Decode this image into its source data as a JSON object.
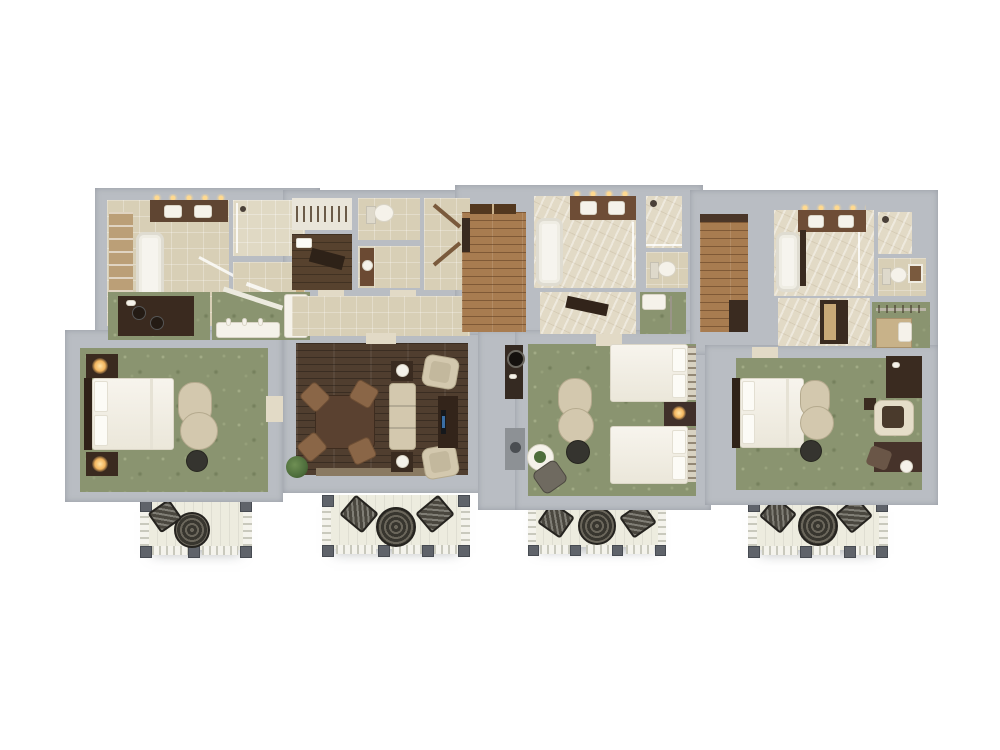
{
  "figure": {
    "type": "floorplan-3d-render",
    "description": "Top-down 3D rendering of a multi-bedroom hotel suite: three bedrooms, living-dining room, three bathrooms, closets, entry corridors and four furnished terraces",
    "background": "#ffffff",
    "visible_text": ""
  },
  "palette": {
    "wall": "#b9bdc3",
    "carpet_green": "#8a9470",
    "tile_beige": "#d8cfb6",
    "marble_cream": "#e2dac6",
    "wood_dark": "#503e2f",
    "wood_medium": "#a87c50",
    "balcony_floor": "#edecdf",
    "post_gray": "#5f636a",
    "upholstery_beige": "#d3c8ae",
    "furniture_brown": "#3a2b20",
    "bedding_white": "#f5f2ea",
    "lamp_glow": "#f3b65f",
    "plant_green": "#4e6e3c"
  },
  "rooms": [
    {
      "name": "Bathroom (left suite)",
      "floor": "tile",
      "items": [
        "double vanity with mirror lights",
        "bathtub",
        "towel shelves"
      ]
    },
    {
      "name": "Shower (left suite)",
      "floor": "tile",
      "items": [
        "glass shower"
      ]
    },
    {
      "name": "Wet room (left suite)",
      "floor": "tile",
      "items": [
        "towel bar",
        "bench"
      ]
    },
    {
      "name": "Dressing room (left suite)",
      "floor": "carpet",
      "items": [
        "vanity dresser"
      ]
    },
    {
      "name": "Walk-in closet (left suite)",
      "floor": "carpet",
      "items": [
        "counter",
        "bench",
        "ironing board"
      ]
    },
    {
      "name": "King bedroom (left suite)",
      "floor": "carpet",
      "items": [
        "king bed",
        "two nightstands with lamps",
        "chaise lounge",
        "round ottoman"
      ]
    },
    {
      "name": "Living and dining room",
      "floor": "dark wood",
      "items": [
        "dining table with four chairs",
        "sofa",
        "two armchairs",
        "two side tables with lamps",
        "TV console",
        "potted plant"
      ]
    },
    {
      "name": "Wardrobe room",
      "floor": "wood",
      "items": [
        "hanging clothes",
        "bench"
      ]
    },
    {
      "name": "Guest toilet",
      "floor": "tile",
      "items": [
        "toilet"
      ]
    },
    {
      "name": "Powder room",
      "floor": "tile",
      "items": [
        "sink vanity"
      ]
    },
    {
      "name": "Hallway",
      "floor": "tile",
      "items": [
        "doors"
      ]
    },
    {
      "name": "Entry hall",
      "floor": "tile",
      "items": []
    },
    {
      "name": "Entry corridor (middle suite)",
      "floor": "wood",
      "items": [
        "double entry door",
        "console"
      ]
    },
    {
      "name": "Bathroom (middle suite)",
      "floor": "marble",
      "items": [
        "double vanity with mirror lights",
        "bathtub",
        "glass partition"
      ]
    },
    {
      "name": "Shower (middle suite)",
      "floor": "marble",
      "items": [
        "glass shower"
      ]
    },
    {
      "name": "Water closet (middle suite)",
      "floor": "tile",
      "items": [
        "toilet"
      ]
    },
    {
      "name": "Dressing area (middle suite)",
      "floor": "marble",
      "items": [
        "bench"
      ]
    },
    {
      "name": "Closet (middle suite)",
      "floor": "carpet",
      "items": [
        "cabinet",
        "hanging rail"
      ]
    },
    {
      "name": "Twin bedroom (middle suite)",
      "floor": "carpet",
      "items": [
        "two beds with upholstered headboards",
        "nightstand with lamp",
        "chaise lounge",
        "round ottoman",
        "round table with plant",
        "chair",
        "kitchenette counters"
      ]
    },
    {
      "name": "Entry corridor (right suite)",
      "floor": "wood",
      "items": [
        "double entry door",
        "cabinet"
      ]
    },
    {
      "name": "Bathroom (right suite)",
      "floor": "marble",
      "items": [
        "double vanity with mirror lights",
        "bathtub",
        "partition",
        "glass panel"
      ]
    },
    {
      "name": "Shower (right suite)",
      "floor": "marble",
      "items": [
        "glass shower"
      ]
    },
    {
      "name": "Water closet (right suite)",
      "floor": "tile",
      "items": [
        "toilet",
        "framed picture"
      ]
    },
    {
      "name": "Dressing room (right suite)",
      "floor": "marble",
      "items": [
        "wardrobe cabinet"
      ]
    },
    {
      "name": "Walk-in closet (right suite)",
      "floor": "carpet",
      "items": [
        "hanging rail",
        "cabinet with safe"
      ]
    },
    {
      "name": "King bedroom (right suite)",
      "floor": "carpet",
      "items": [
        "king bed",
        "chaise lounge",
        "round ottoman",
        "dresser",
        "armchair with side table",
        "desk with chair"
      ]
    }
  ],
  "balconies": [
    {
      "name": "Terrace (left suite)",
      "furniture": [
        "round wicker table",
        "one wicker chair"
      ]
    },
    {
      "name": "Terrace (living room)",
      "furniture": [
        "round wicker table",
        "two wicker chairs"
      ]
    },
    {
      "name": "Terrace (middle suite)",
      "furniture": [
        "round wicker table",
        "two wicker chairs"
      ]
    },
    {
      "name": "Terrace (right suite)",
      "furniture": [
        "round wicker table",
        "two wicker chairs"
      ]
    }
  ]
}
